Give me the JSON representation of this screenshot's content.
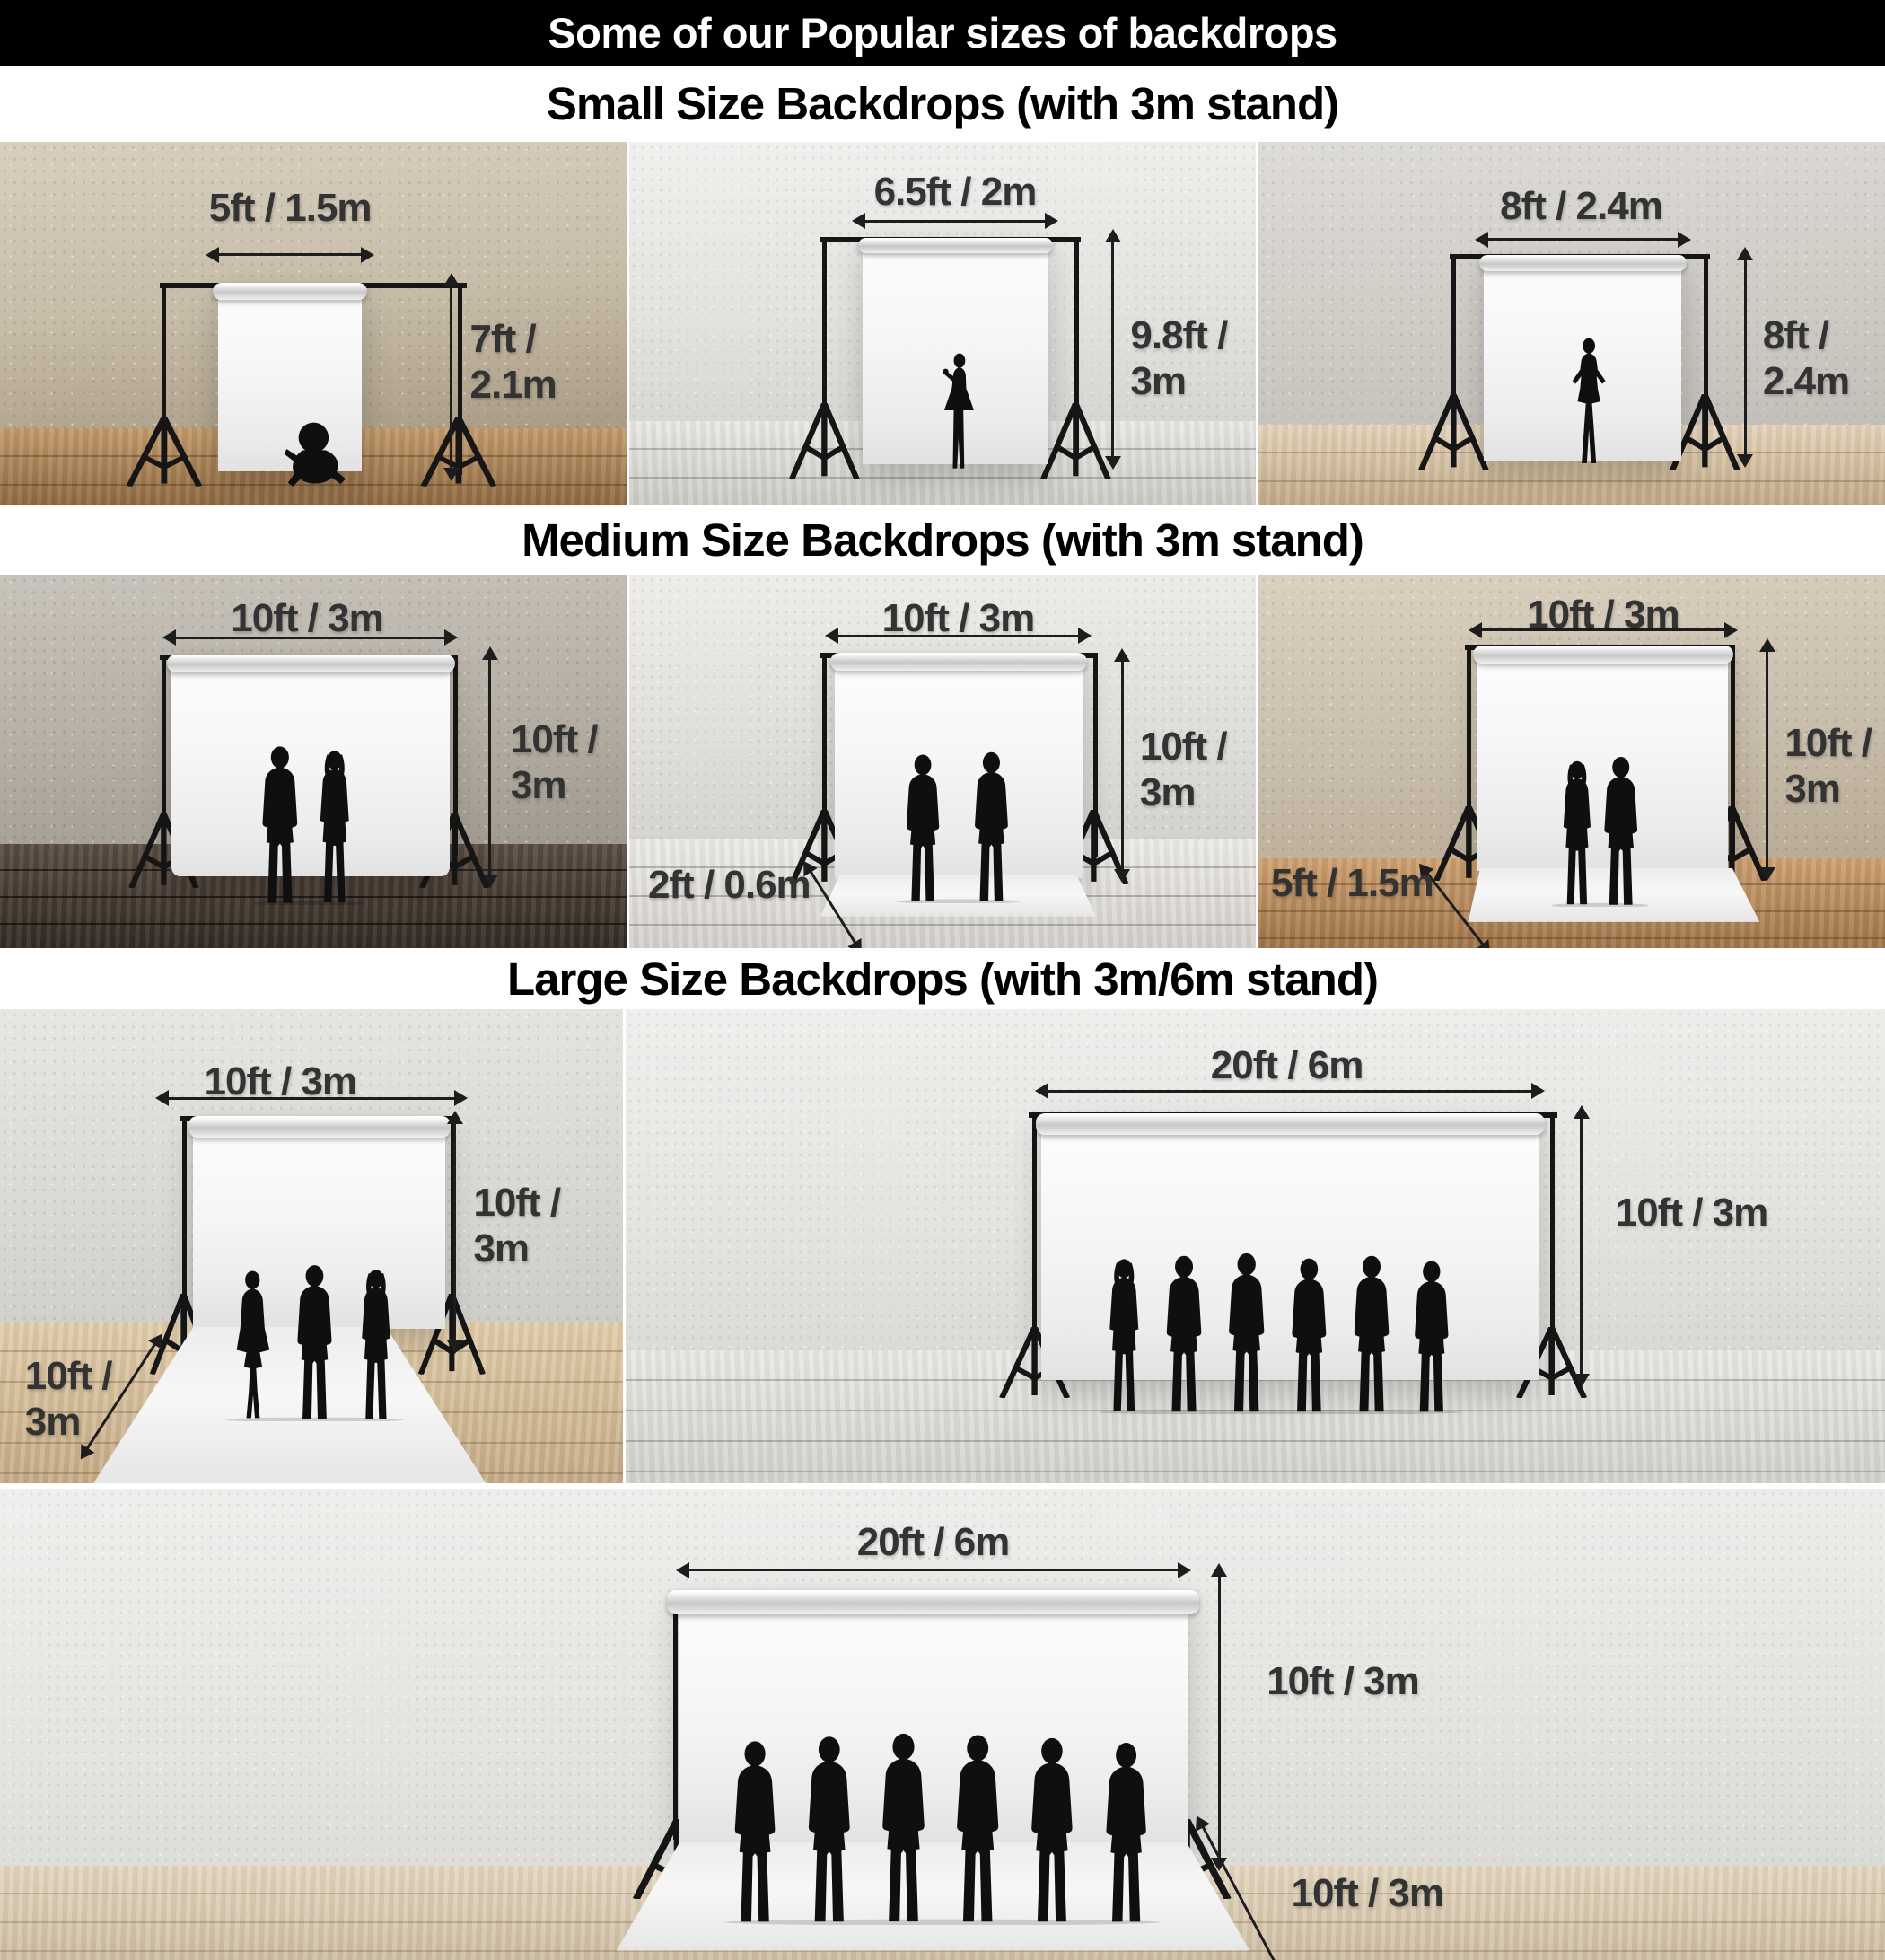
{
  "header": {
    "title": "Some of our Popular sizes of backdrops"
  },
  "colors": {
    "header_bg": "#000000",
    "header_text": "#ffffff",
    "title_text": "#000000",
    "dimension_text": "#333333",
    "silhouette": "#0f0f0f",
    "backdrop_white": "#f7f7f7"
  },
  "sections": [
    {
      "title": "Small Size Backdrops (with 3m stand)",
      "panels": [
        {
          "name": "5ft backdrop",
          "width_label": "5ft / 1.5m",
          "height_line1": "7ft /",
          "height_line2": "2.1m",
          "figure": "sitting-baby-silhouette"
        },
        {
          "name": "6.5ft backdrop",
          "width_label": "6.5ft / 2m",
          "height_line1": "9.8ft /",
          "height_line2": "3m",
          "figure": "girl-in-dress-silhouette"
        },
        {
          "name": "8ft backdrop",
          "width_label": "8ft / 2.4m",
          "height_line1": "8ft /",
          "height_line2": "2.4m",
          "figure": "posing-woman-silhouette"
        }
      ]
    },
    {
      "title": "Medium Size Backdrops (with 3m stand)",
      "panels": [
        {
          "name": "10ft backdrop",
          "width_label": "10ft / 3m",
          "height_line1": "10ft /",
          "height_line2": "3m",
          "figure": "couple-silhouette"
        },
        {
          "name": "10ft backdrop with 2ft sweep",
          "width_label": "10ft / 3m",
          "height_line1": "10ft /",
          "height_line2": "3m",
          "floor_label": "2ft / 0.6m",
          "figure": "two-men-silhouette"
        },
        {
          "name": "10ft backdrop with 5ft sweep",
          "width_label": "10ft / 3m",
          "height_line1": "10ft /",
          "height_line2": "3m",
          "floor_label": "5ft / 1.5m",
          "figure": "couple-silhouette"
        }
      ]
    },
    {
      "title": "Large Size Backdrops (with 3m/6m stand)",
      "panels": [
        {
          "name": "10ft backdrop with 10ft sweep",
          "width_label": "10ft / 3m",
          "height_line1": "10ft /",
          "height_line2": "3m",
          "floor_line1": "10ft /",
          "floor_line2": "3m",
          "figure": "three-business-people-silhouette"
        },
        {
          "name": "20ft backdrop",
          "width_label": "20ft / 6m",
          "height_label": "10ft / 3m",
          "figure": "six-people-group-silhouette"
        },
        {
          "name": "20ft backdrop with 10ft sweep",
          "width_label": "20ft / 6m",
          "height_label": "10ft / 3m",
          "floor_label": "10ft / 3m",
          "figure": "six-men-in-suits-silhouette"
        }
      ]
    }
  ]
}
